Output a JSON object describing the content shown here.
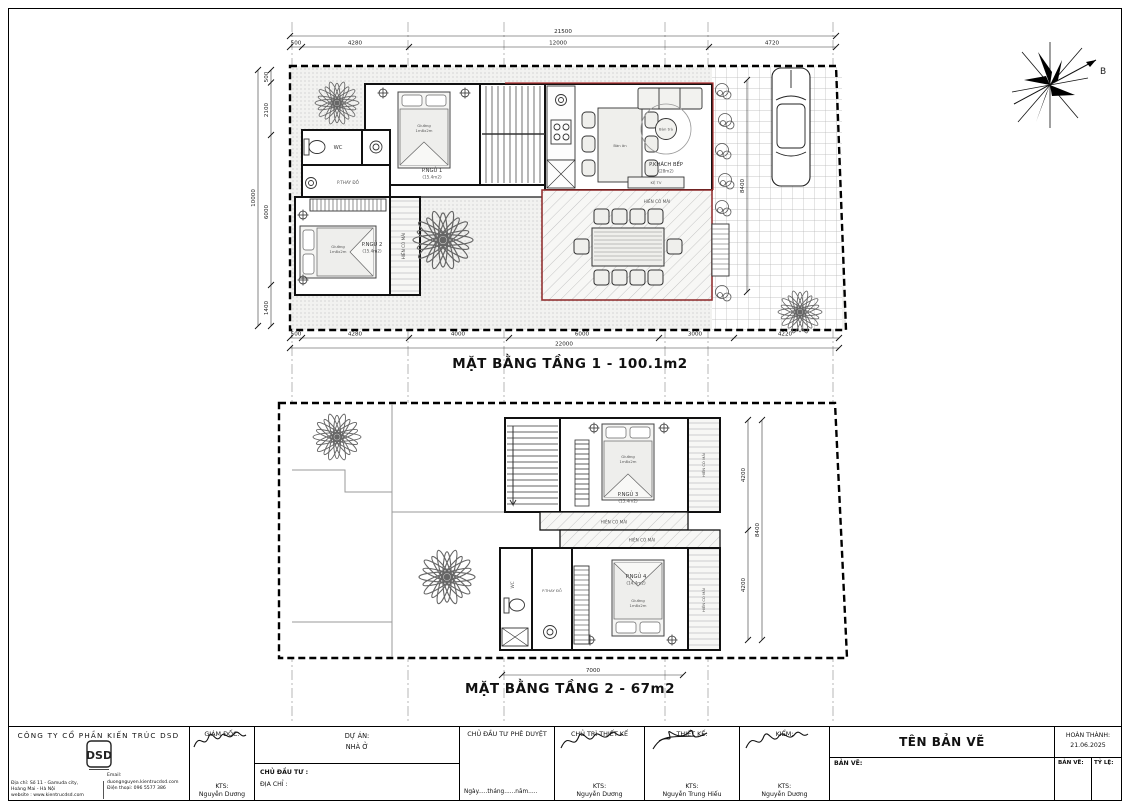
{
  "colors": {
    "red_outline": "#b03030",
    "wall": "#111111",
    "hatch": "#b9b9b9"
  },
  "compass": {
    "north_label": "B"
  },
  "bed": {
    "line1": "Giường",
    "line2": "1m8x2m"
  },
  "plan1": {
    "title": "MẶT BẰNG TẦNG 1 - 100.1m2",
    "dim_total_top": "21500",
    "dims_top": [
      "500",
      "4280",
      "12000",
      "4720"
    ],
    "dim_total_bottom": "22000",
    "dims_bottom": [
      "500",
      "4280",
      "4000",
      "6000",
      "3000",
      "4220"
    ],
    "dim_total_left": "10000",
    "dims_left": [
      "500",
      "2100",
      "6000",
      "1400"
    ],
    "dim_yard": "8400",
    "labels": {
      "bedroom1": "P.NGỦ 1",
      "bedroom1_area": "(15.4m2)",
      "wc": "WC",
      "dressing": "P.THAY ĐỒ",
      "bedroom2": "P.NGỦ 2",
      "bedroom2_area": "(15.4m2)",
      "porch": "HIÊN CÓ MÁI",
      "living": "P.KHÁCH BẾP",
      "living_area": "(28m2)",
      "dining_table": "Bàn ăn",
      "tea_table": "Bàn trà",
      "tv_shelf": "KỆ TV",
      "terrace": "HIÊN CÓ MÁI"
    }
  },
  "plan2": {
    "title": "MẶT BẰNG TẦNG 2 - 67m2",
    "dims_right": [
      "4200",
      "4200"
    ],
    "dim_total_right": "8400",
    "dim_bottom": "7000",
    "labels": {
      "bedroom3": "P.NGỦ 3",
      "bedroom3_area": "(15.4m2)",
      "bedroom4": "P.NGỦ 4",
      "bedroom4_area": "(14.4m2)",
      "wc": "WC",
      "dressing": "P.THAY ĐỒ",
      "porch": "HIÊN CÓ MÁI"
    }
  },
  "titleblock": {
    "company_name": "CÔNG TY CỔ PHẦN KIẾN TRÚC DSD",
    "logo_text": "DSD",
    "address_line1": "Địa chỉ: Số 11 - Gamuda city,",
    "address_line2": "Hoàng Mai - Hà Nội",
    "website": "website : www.kientrucdsd.com",
    "email": "Email: duongnguyen.kientrucdsd.com",
    "phone": "Điện thoại: 096 5577 386",
    "director_label": "GIÁM ĐỐC:",
    "director_title": "KTS:",
    "director_name": "Nguyễn Dương",
    "project_label": "DỰ ÁN:",
    "project_name": "NHÀ Ở",
    "investor_label": "CHỦ ĐẦU TƯ :",
    "site_address_label": "ĐỊA CHỈ :",
    "approval_label": "CHỦ ĐẦU TƯ PHÊ DUYỆT",
    "date_line": "Ngày.....tháng......năm.....",
    "lead_label": "CHỦ TRÌ THIẾT KẾ",
    "lead_title": "KTS:",
    "lead_name": "Nguyễn Dương",
    "designer_label": "THIẾT KẾ:",
    "designer_title": "KTS:",
    "designer_name": "Nguyễn Trung Hiếu",
    "checker_label": "KIỂM:",
    "checker_title": "KTS:",
    "checker_name": "Nguyễn Dương",
    "drawing_title": "TÊN BẢN VẼ",
    "drawing_label": "BẢN VẼ:",
    "completed_label": "HOÀN THÀNH:",
    "completed_date": "21.06.2025",
    "sheet_label": "BẢN VẼ:",
    "scale_label": "TỶ LỆ:"
  }
}
